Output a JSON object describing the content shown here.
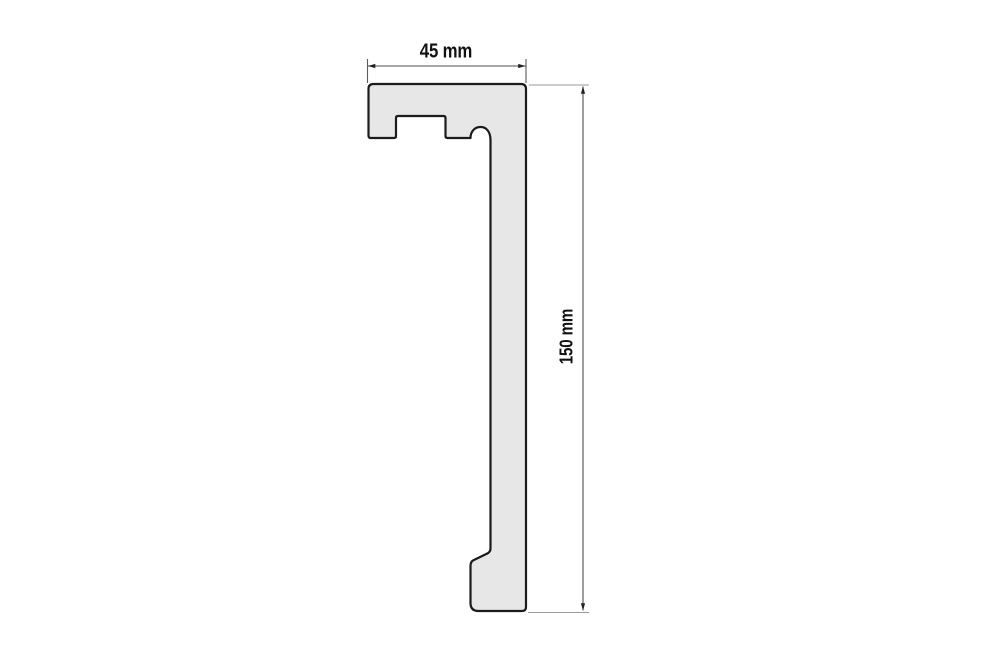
{
  "diagram": {
    "type": "technical-profile-cross-section",
    "width_dimension": {
      "label": "45 mm",
      "value_mm": 45
    },
    "height_dimension": {
      "label": "150 mm",
      "value_mm": 150
    },
    "colors": {
      "background": "#ffffff",
      "profile_fill": "#e7e7e7",
      "profile_outline": "#1b1b1b",
      "dimension_line": "#4d4d4d",
      "extension_line": "#999999",
      "text": "#111111"
    }
  }
}
